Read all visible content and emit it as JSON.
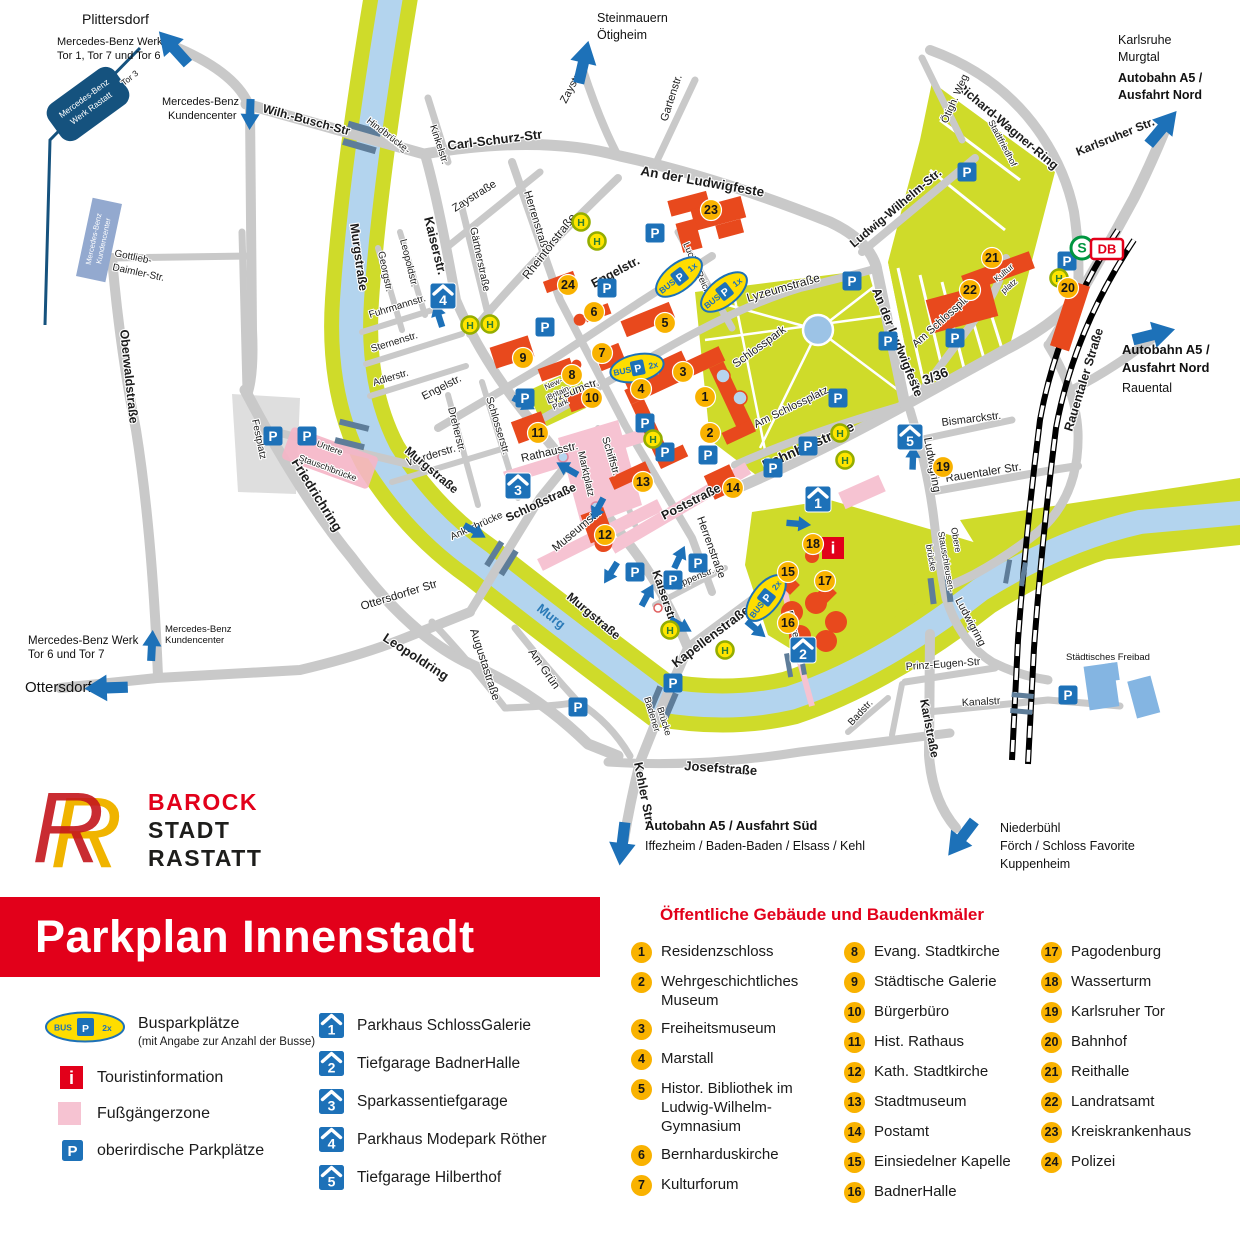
{
  "banner": {
    "title": "Parkplan Innenstadt"
  },
  "logo": {
    "monogram": "R",
    "line1": "BAROCK",
    "line2": "STADT",
    "line3": "RASTATT"
  },
  "icons": {
    "p": "P",
    "h": "H",
    "info": "i",
    "s_bahn": "S",
    "db": "DB",
    "bus": "BUS",
    "count_1x": "1x",
    "count_2x": "2x"
  },
  "legend": {
    "bus_label": "Busparkplätze",
    "bus_note": "(mit Angabe zur Anzahl der Busse)",
    "tourist_label": "Touristinformation",
    "pedestrian_label": "Fußgängerzone",
    "parking_label": "oberirdische Parkplätze",
    "parkhaeuser": [
      {
        "num": "1",
        "label": "Parkhaus SchlossGalerie"
      },
      {
        "num": "2",
        "label": "Tiefgarage BadnerHalle"
      },
      {
        "num": "3",
        "label": "Sparkassentiefgarage"
      },
      {
        "num": "4",
        "label": "Parkhaus Modepark Röther"
      },
      {
        "num": "5",
        "label": "Tiefgarage Hilberthof"
      }
    ],
    "buildings_title": "Öffentliche Gebäude und Baudenkmäler",
    "buildings": [
      {
        "num": "1",
        "label": "Residenzschloss"
      },
      {
        "num": "2",
        "label": "Wehrgeschichtliches Museum"
      },
      {
        "num": "3",
        "label": "Freiheitsmuseum"
      },
      {
        "num": "4",
        "label": "Marstall"
      },
      {
        "num": "5",
        "label": "Histor. Bibliothek im Ludwig-Wilhelm-Gymnasium"
      },
      {
        "num": "6",
        "label": "Bernharduskirche"
      },
      {
        "num": "7",
        "label": "Kulturforum"
      },
      {
        "num": "8",
        "label": "Evang. Stadtkirche"
      },
      {
        "num": "9",
        "label": "Städtische Galerie"
      },
      {
        "num": "10",
        "label": "Bürgerbüro"
      },
      {
        "num": "11",
        "label": "Hist. Rathaus"
      },
      {
        "num": "12",
        "label": "Kath. Stadtkirche"
      },
      {
        "num": "13",
        "label": "Stadtmuseum"
      },
      {
        "num": "14",
        "label": "Postamt"
      },
      {
        "num": "15",
        "label": "Einsiedelner Kapelle"
      },
      {
        "num": "16",
        "label": "BadnerHalle"
      },
      {
        "num": "17",
        "label": "Pagodenburg"
      },
      {
        "num": "18",
        "label": "Wasserturm"
      },
      {
        "num": "19",
        "label": "Karlsruher Tor"
      },
      {
        "num": "20",
        "label": "Bahnhof"
      },
      {
        "num": "21",
        "label": "Reithalle"
      },
      {
        "num": "22",
        "label": "Landratsamt"
      },
      {
        "num": "23",
        "label": "Kreiskrankenhaus"
      },
      {
        "num": "24",
        "label": "Polizei"
      }
    ]
  },
  "map": {
    "destinations": {
      "plittersdorf": "Plittersdorf",
      "mb_werk_nw_1": "Mercedes-Benz Werk",
      "mb_werk_nw_2": "Tor 1, Tor 7 und Tor 6",
      "mb_kunden_1": "Mercedes-Benz",
      "mb_kunden_2": "Kundencenter",
      "steinmauern": "Steinmauern",
      "oetigheim": "Ötigheim",
      "karlsruhe": "Karlsruhe",
      "murgtal": "Murgtal",
      "a5_nord_1": "Autobahn A5 /",
      "a5_nord_2": "Ausfahrt Nord",
      "rauental": "Rauental",
      "mb_werk_sw_1": "Mercedes-Benz Werk",
      "mb_werk_sw_2": "Tor 6 und Tor 7",
      "ottersdorf": "Ottersdorf",
      "mb_kunden_sm_1": "Mercedes-Benz",
      "mb_kunden_sm_2": "Kundencenter",
      "a5_sued_1": "Autobahn A5 / Ausfahrt Süd",
      "a5_sued_2": "Iffezheim / Baden-Baden / Elsass / Kehl",
      "niederbuehl_1": "Niederbühl",
      "niederbuehl_2": "Förch / Schloss Favorite",
      "niederbuehl_3": "Kuppenheim"
    },
    "streets": {
      "wilh_busch": "Wilh.-Busch-Str",
      "carl_schurz": "Carl-Schurz-Str",
      "zaystr": "Zaystr.",
      "zaystrasse": "Zaystraße",
      "kinkelstr": "Kinkelstr.",
      "hindenburg_1": "Hindenburg-",
      "hindenburg_2": "brücke",
      "gartenstr": "Gartenstr.",
      "an_der_ludwigfeste": "An der Ludwigfeste",
      "herrenstrasse": "Herrenstraße",
      "rheintorstrasse": "Rheintorstraße",
      "gaertnerstrasse": "Gärtnerstraße",
      "kaiserstr": "Kaiserstr.",
      "leopoldstr": "Leopoldstr.",
      "georgstr": "Georgstr.",
      "fuhrmannstr": "Fuhrmannstr.",
      "sternenstr": "Sternenstr.",
      "adlerstr": "Adlerstr.",
      "engelstr": "Engelstr.",
      "dreherstr": "Dreherstr.",
      "schlosserstr": "Schlosserstr.",
      "werderstr": "Werderstr.",
      "murgstrasse": "Murgstraße",
      "friedrichring": "Friedrichring",
      "leopoldring": "Leopoldring",
      "oberwaldstrasse": "Oberwaldstraße",
      "untere_1": "Untere",
      "untere_2": "Stauschleusen-",
      "untere_3": "brücke",
      "ankerbruecke": "Ankerbrücke",
      "ottersdorfer_str": "Ottersdorfer Str",
      "augustastrasse": "Augustastraße",
      "am_gruen": "Am Grün",
      "schlossstrasse": "Schloßstraße",
      "rathausstr": "Rathausstr.",
      "schiffstr": "Schiffstr.",
      "museumstr": "Museumstr.",
      "poststrasse": "Poststraße",
      "rappenstr": "Rappenstr.",
      "kapellenstrasse": "Kapellenstraße",
      "rohrer_steg": "Rohrer Steg",
      "kehler_str": "Kehler Str.",
      "badener_1": "Badener",
      "badener_2": "Brücke",
      "josefstrasse": "Josefstraße",
      "prinz_eugen": "Prinz-Eugen-Str",
      "kanalstr": "Kanalstr",
      "badstr": "Badstr.",
      "karlstrasse": "Karlstraße",
      "ludwigring": "Ludwigring",
      "obere_1": "Obere",
      "obere_2": "Stauschleusen-",
      "obere_3": "brücke",
      "bahnhofstrasse": "Bahnhofstraße",
      "b336": "B 3/36",
      "bismarckstr": "Bismarckstr.",
      "rauentaler_str": "Rauentaler Str.",
      "rauentaler_strasse": "Rauentaler Straße",
      "am_schlossplatz": "Am Schlossplatz",
      "lyzeumstrasse": "Lyzeumstraße",
      "lyzeumstr": "Lyzeumstr.",
      "lucian_reich": "Lucian-Reich-Str.",
      "ludwig_wilhelm": "Ludwig-Wilhelm-Str.",
      "richard_wagner": "Richard-Wagner-Ring",
      "oetigh_weg": "Ötigh. Weg",
      "karlsruher_str": "Karlsruher Str.",
      "gottlieb_1": "Gottlieb-",
      "gottlieb_2": "Daimler-Str."
    },
    "places": {
      "festplatz": "Festplatz",
      "schlosspark": "Schlosspark",
      "stadtfriedhof": "Stadtfriedhof",
      "marktplatz": "Marktplatz",
      "kultur_1": "Kultur",
      "kultur_2": "platz",
      "freibad": "Städtisches Freibad",
      "murg": "Murg",
      "tor3": "Tor 3",
      "new_britain_1": "New-",
      "new_britain_2": "Britain-",
      "new_britain_3": "Park",
      "mb_werk_1": "Mercedes-Benz",
      "mb_werk_2": "Werk Rastatt",
      "mb_kunden_1": "Mercedes-Benz",
      "mb_kunden_2": "Kundencenter"
    }
  }
}
